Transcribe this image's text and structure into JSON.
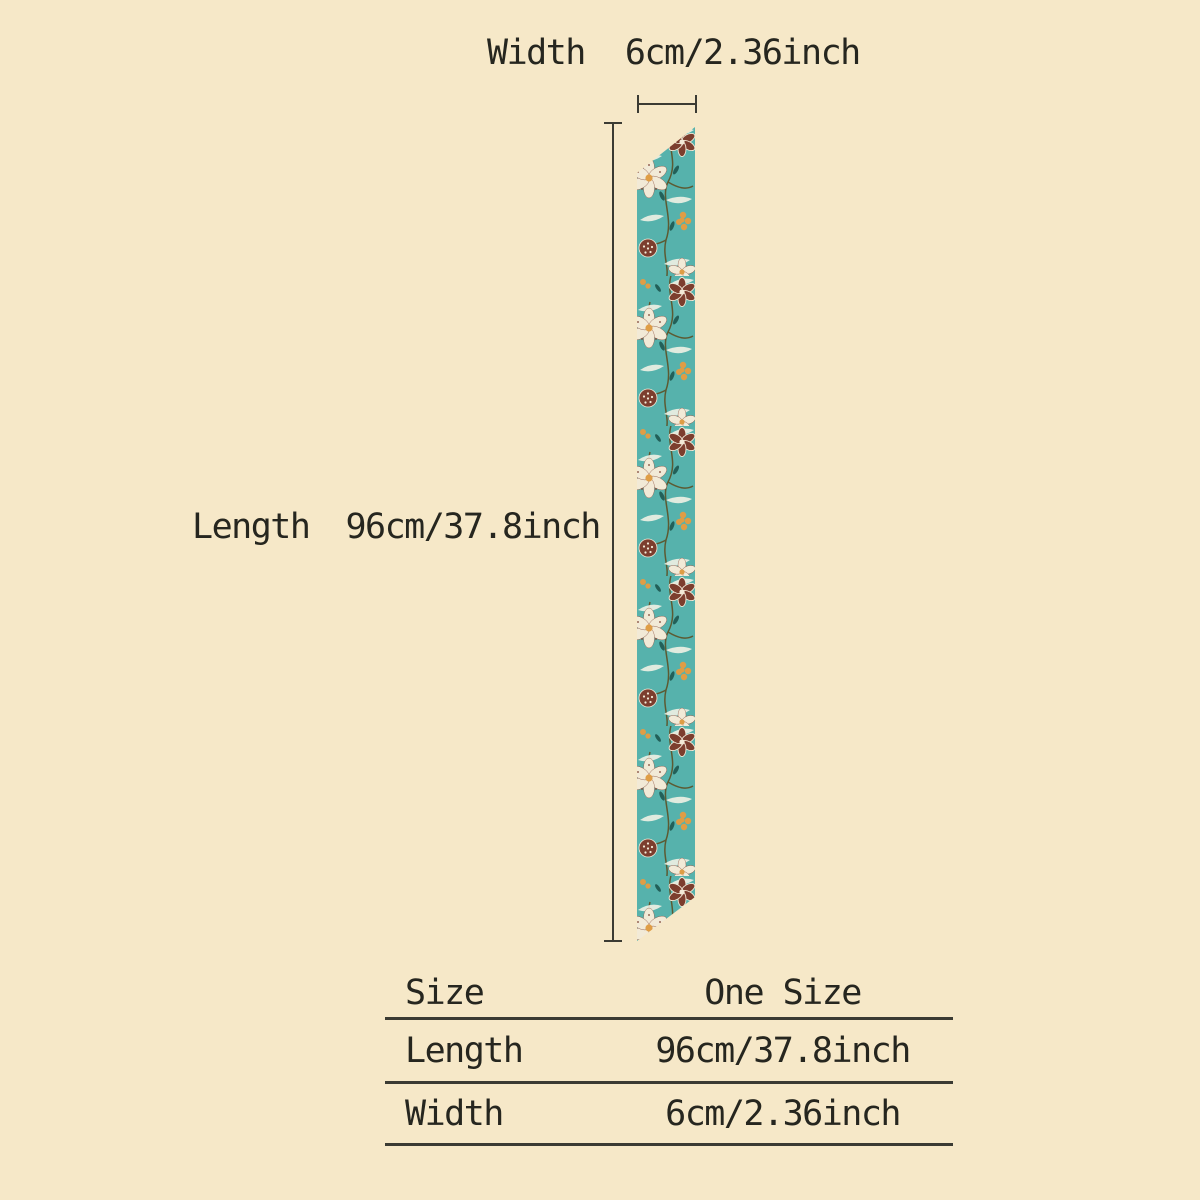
{
  "theme": {
    "background": "#f6e8c8",
    "text": "#26261f",
    "line": "#3b3b33",
    "scarf_teal": "#56b2ac",
    "floral_cream": "#f2ead7",
    "floral_maroon": "#7c3e2e",
    "floral_mustard": "#df9d45",
    "floral_white": "#f4f2e6",
    "stem_dark": "#5c5a32",
    "leaf_teal": "#226059"
  },
  "annotations": {
    "width": {
      "label": "Width",
      "value": "6cm/2.36inch"
    },
    "length": {
      "label": "Length",
      "value": "96cm/37.8inch"
    }
  },
  "size_table": {
    "rows": [
      {
        "label": "Size",
        "value": "One Size"
      },
      {
        "label": "Length",
        "value": "96cm/37.8inch"
      },
      {
        "label": "Width",
        "value": "6cm/2.36inch"
      }
    ]
  }
}
